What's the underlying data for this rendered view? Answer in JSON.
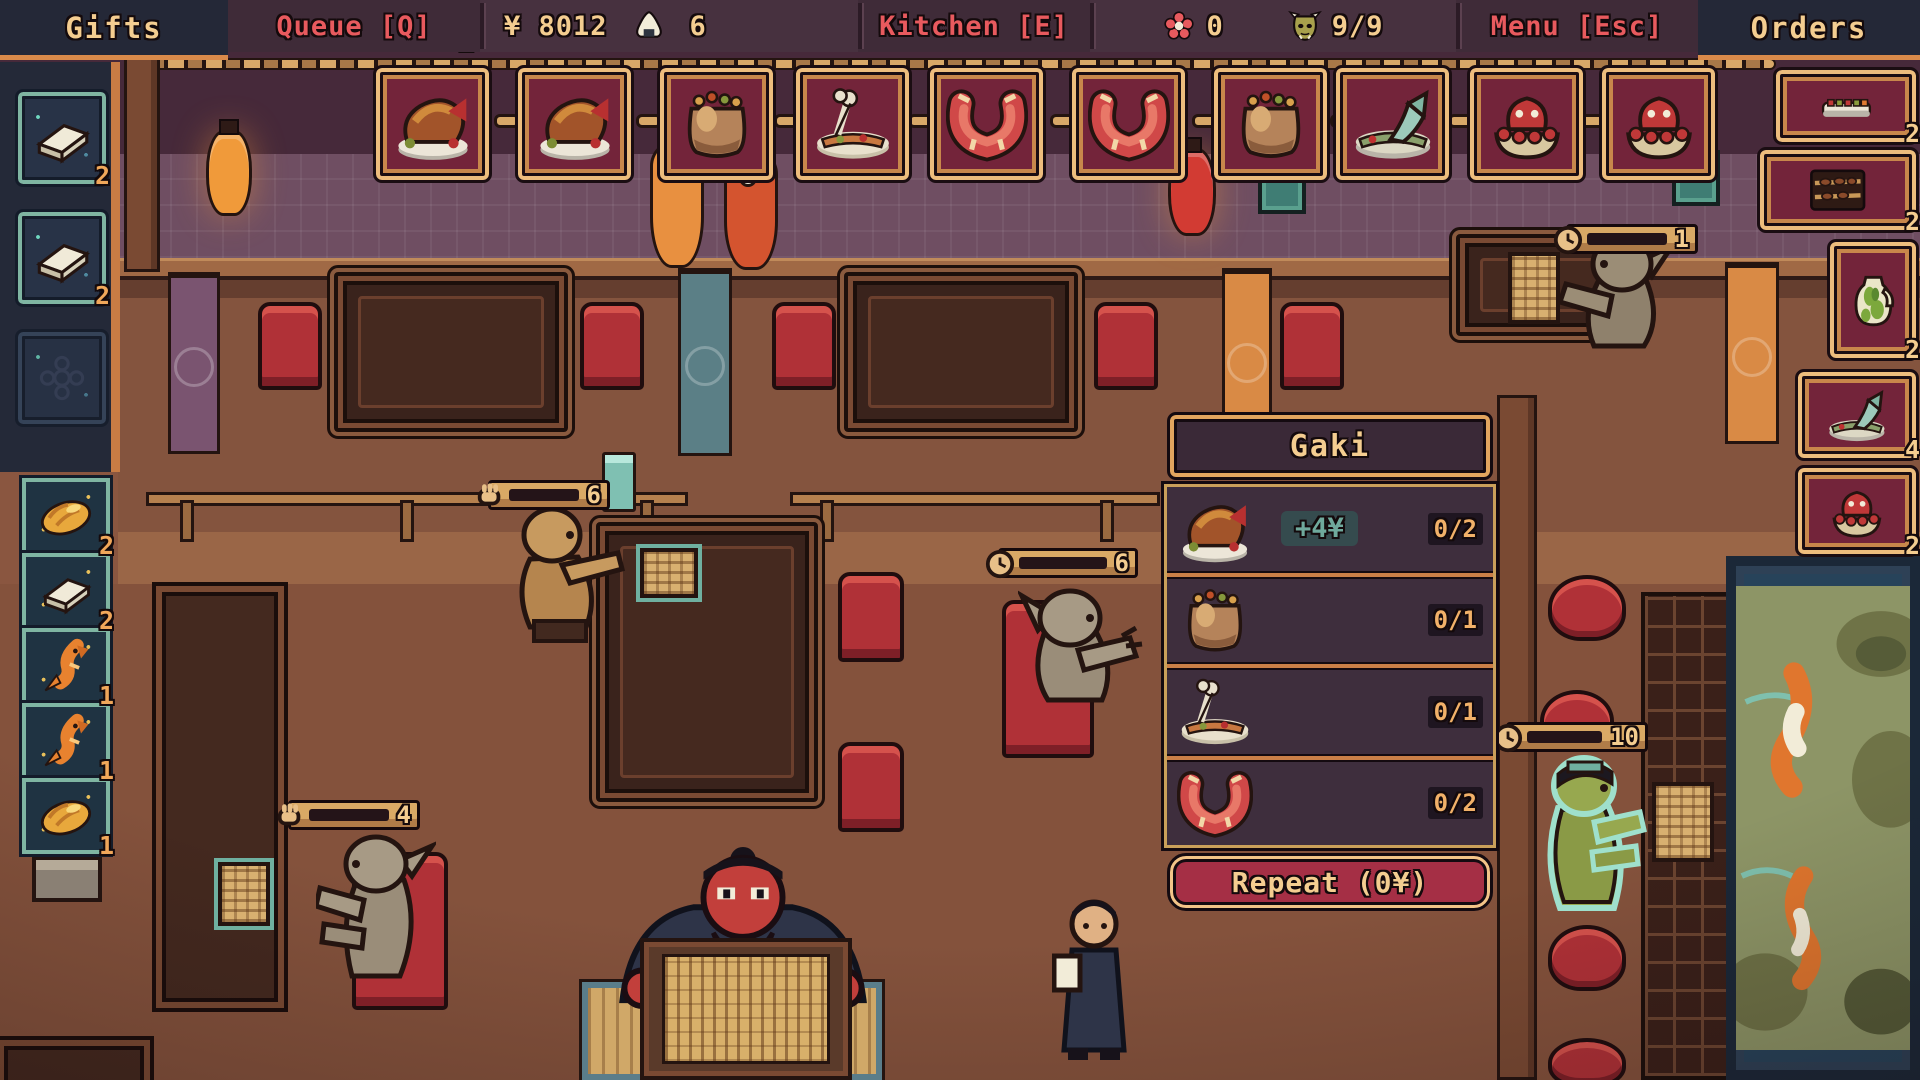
{
  "topbar": {
    "gifts_label": "Gifts",
    "queue_label": "Queue [Q]",
    "money": "¥ 8012",
    "rice_icon": "onigiri",
    "rice_count": "6",
    "kitchen_label": "Kitchen [E]",
    "flower_icon": "sakura",
    "flower_count": "0",
    "mask_icon": "oni-mask",
    "mask_count": "9/9",
    "menu_label": "Menu [Esc]",
    "orders_label": "Orders"
  },
  "recipe_bar": {
    "queue_badge": "1",
    "slots": [
      {
        "icon": "roast-chicken"
      },
      {
        "icon": "roast-chicken"
      },
      {
        "icon": "clay-pot"
      },
      {
        "icon": "bone-plate"
      },
      {
        "icon": "shrimp"
      },
      {
        "icon": "shrimp"
      },
      {
        "icon": "clay-pot"
      },
      {
        "icon": "fish-platter"
      },
      {
        "icon": "octopus-bowl"
      },
      {
        "icon": "octopus-bowl"
      }
    ]
  },
  "gifts_panel": {
    "slots": [
      {
        "icon": "tofu",
        "count": "2"
      },
      {
        "icon": "tofu",
        "count": "2"
      },
      {
        "icon": "empty-slot",
        "count": ""
      }
    ]
  },
  "supply_strip": {
    "slots": [
      {
        "icon": "golden-loaf",
        "count": "2"
      },
      {
        "icon": "tofu",
        "count": "2"
      },
      {
        "icon": "koi-fish",
        "count": "1"
      },
      {
        "icon": "koi-fish",
        "count": "1"
      },
      {
        "icon": "golden-loaf",
        "count": "1"
      }
    ]
  },
  "orders_panel": {
    "slots": [
      {
        "icon": "sushi-row",
        "count": "2"
      },
      {
        "icon": "skewer-rack",
        "count": "2"
      },
      {
        "icon": "green-jug",
        "count": "2"
      },
      {
        "icon": "fish-platter",
        "count": "4"
      },
      {
        "icon": "octopus-bowl",
        "count": "2"
      }
    ]
  },
  "order_popup": {
    "title": "Gaki",
    "items": [
      {
        "icon": "roast-chicken",
        "bonus": "+4¥",
        "progress": "0/2"
      },
      {
        "icon": "clay-pot",
        "bonus": "",
        "progress": "0/1"
      },
      {
        "icon": "bone-plate",
        "bonus": "",
        "progress": "0/1"
      },
      {
        "icon": "shrimp",
        "bonus": "",
        "progress": "0/2"
      }
    ],
    "repeat_label": "Repeat (0¥)"
  },
  "patience_bars": [
    {
      "value": "6",
      "fill": 0.52,
      "kind": "serve",
      "icon": "hand"
    },
    {
      "value": "6",
      "fill": 0.9,
      "kind": "wait",
      "icon": "clock"
    },
    {
      "value": "1",
      "fill": 0.95,
      "kind": "wait",
      "icon": "clock"
    },
    {
      "value": "10",
      "fill": 0.85,
      "kind": "wait",
      "icon": "clock"
    },
    {
      "value": "4",
      "fill": 0.7,
      "kind": "serve",
      "icon": "hand"
    }
  ],
  "colors": {
    "accent_orange": "#e09a55",
    "cream_text": "#f4cd90",
    "red_text": "#e85a5e",
    "teal_accent": "#7fb5a2",
    "slot_crimson": "#73243a",
    "panel_navy": "#242938",
    "button_red": "#a52f45"
  }
}
